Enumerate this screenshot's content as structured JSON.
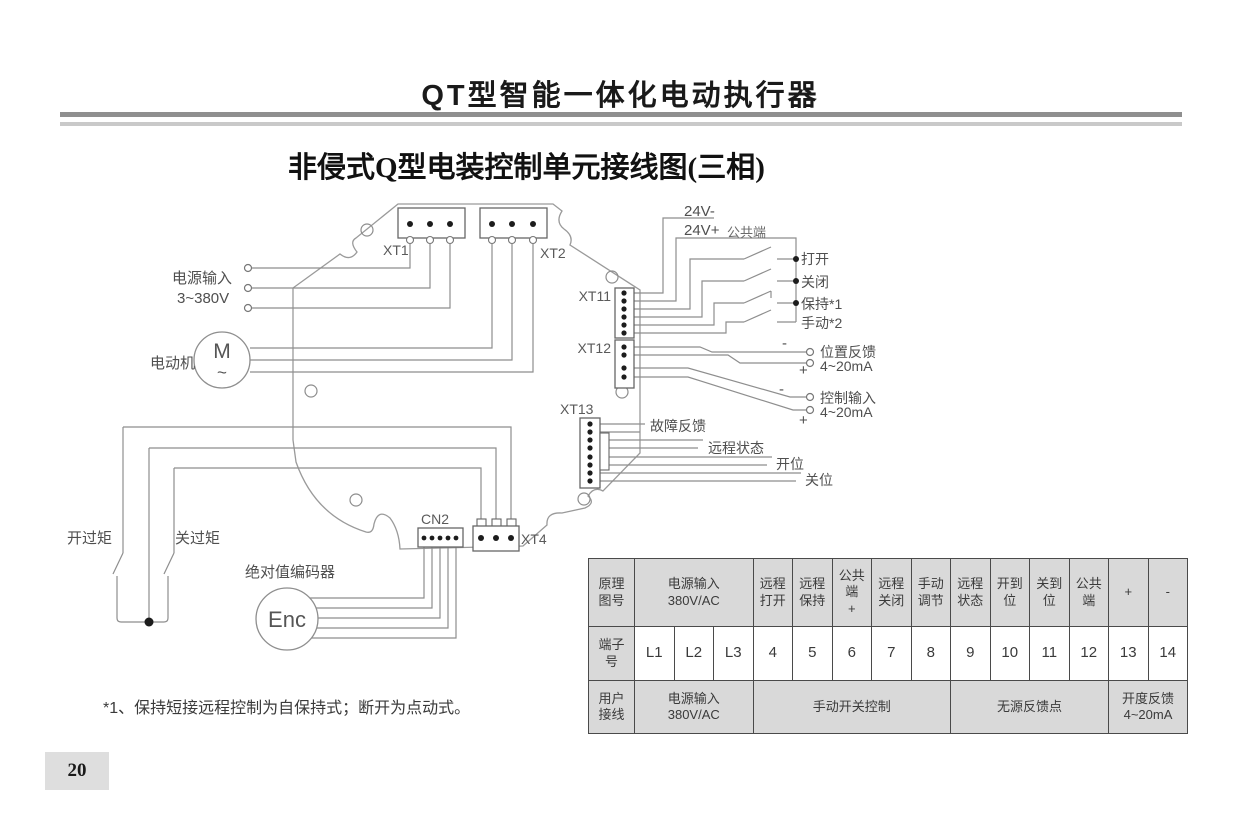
{
  "page": {
    "title": "QT型智能一体化电动执行器",
    "subtitle": "非侵式Q型电装控制单元接线图(三相)",
    "footnote": "*1、保持短接远程控制为自保持式；断开为点动式。",
    "page_number": "20"
  },
  "diagram": {
    "labels": {
      "power_input": "电源输入",
      "power_voltage": "3~380V",
      "motor": "电动机",
      "motor_symbol": "M",
      "motor_wave": "~",
      "xt1": "XT1",
      "xt2": "XT2",
      "xt11": "XT11",
      "xt12": "XT12",
      "xt13": "XT13",
      "xt4": "XT4",
      "cn2": "CN2",
      "v24_minus": "24V-",
      "v24_plus": "24V+",
      "common_terminal": "公共端",
      "remote_open": "打开",
      "remote_close": "关闭",
      "remote_hold": "保持*1",
      "remote_manual": "手动*2",
      "position_feedback": "位置反馈",
      "position_feedback_range": "4~20mA",
      "control_input": "控制输入",
      "control_input_range": "4~20mA",
      "minus1": "-",
      "plus1": "+",
      "minus2": "-",
      "plus2": "+",
      "fault_feedback": "故障反馈",
      "remote_status": "远程状态",
      "open_position": "开位",
      "close_position": "关位",
      "open_torque": "开过矩",
      "close_torque": "关过矩",
      "encoder": "绝对值编码器",
      "encoder_symbol": "Enc"
    }
  },
  "table": {
    "header_row": {
      "label": "原理\n图号",
      "cells": [
        "电源输入\n380V/AC",
        "远程\n打开",
        "远程\n保持",
        "公共\n端\n+",
        "远程\n关闭",
        "手动\n调节",
        "远程\n状态",
        "开到\n位",
        "关到\n位",
        "公共\n端",
        "+",
        "-"
      ]
    },
    "terminal_row": {
      "label": "端子\n号",
      "cells": [
        "L1",
        "L2",
        "L3",
        "4",
        "5",
        "6",
        "7",
        "8",
        "9",
        "10",
        "11",
        "12",
        "13",
        "14"
      ]
    },
    "user_row": {
      "label": "用户\n接线",
      "cells": [
        "电源输入\n380V/AC",
        "手动开关控制",
        "无源反馈点",
        "开度反馈\n4~20mA"
      ]
    }
  }
}
